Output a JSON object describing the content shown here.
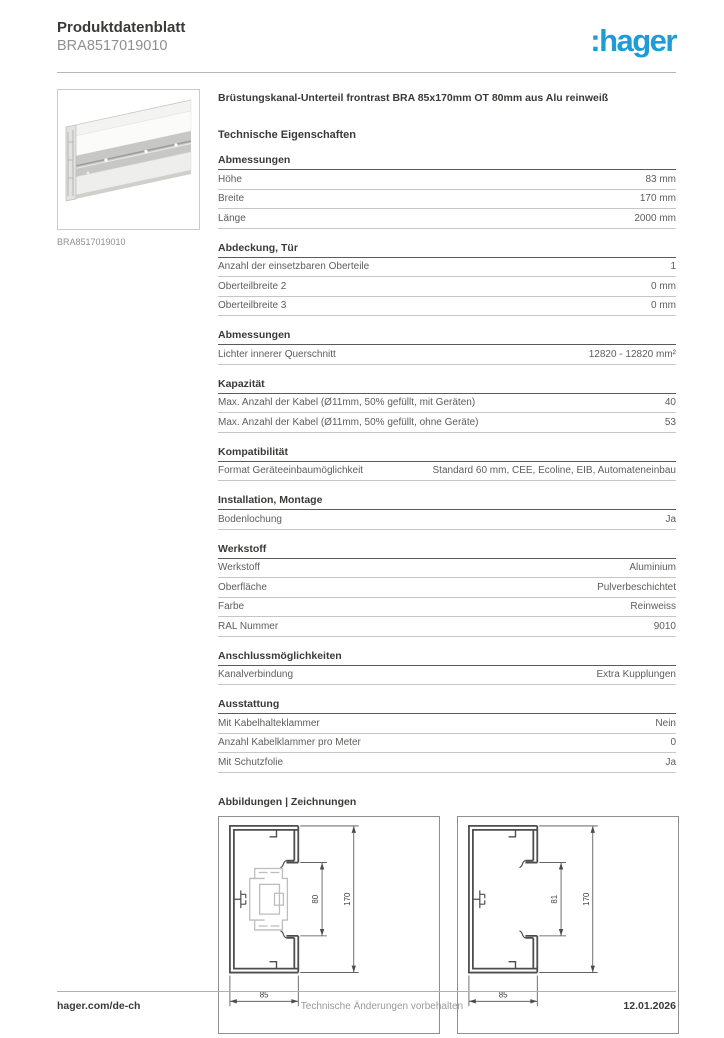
{
  "header": {
    "doc_type": "Produktdatenblatt",
    "product_ref": "BRA8517019010",
    "logo_text": ":hager",
    "logo_color": "#1d9cd8"
  },
  "product": {
    "image_caption": "BRA8517019010",
    "title": "Brüstungskanal-Unterteil frontrast BRA 85x170mm OT 80mm aus Alu reinweiß",
    "tech_section_title": "Technische Eigenschaften"
  },
  "spec_sections": [
    {
      "heading": "Abmessungen",
      "rows": [
        {
          "label": "Höhe",
          "value": "83 mm"
        },
        {
          "label": "Breite",
          "value": "170 mm"
        },
        {
          "label": "Länge",
          "value": "2000 mm"
        }
      ]
    },
    {
      "heading": "Abdeckung, Tür",
      "rows": [
        {
          "label": "Anzahl der einsetzbaren Oberteile",
          "value": "1"
        },
        {
          "label": "Oberteilbreite 2",
          "value": "0 mm"
        },
        {
          "label": "Oberteilbreite 3",
          "value": "0 mm"
        }
      ]
    },
    {
      "heading": "Abmessungen",
      "rows": [
        {
          "label": "Lichter innerer Querschnitt",
          "value": "12820 - 12820 mm²"
        }
      ]
    },
    {
      "heading": "Kapazität",
      "rows": [
        {
          "label": "Max. Anzahl der Kabel (Ø11mm, 50% gefüllt, mit Geräten)",
          "value": "40"
        },
        {
          "label": "Max. Anzahl der Kabel (Ø11mm, 50% gefüllt, ohne Geräte)",
          "value": "53"
        }
      ]
    },
    {
      "heading": "Kompatibilität",
      "rows": [
        {
          "label": "Format Geräteeinbaumöglichkeit",
          "value": "Standard 60 mm, CEE, Ecoline, EIB, Automateneinbau"
        }
      ]
    },
    {
      "heading": "Installation, Montage",
      "rows": [
        {
          "label": "Bodenlochung",
          "value": "Ja"
        }
      ]
    },
    {
      "heading": "Werkstoff",
      "rows": [
        {
          "label": "Werkstoff",
          "value": "Aluminium"
        },
        {
          "label": "Oberfläche",
          "value": "Pulverbeschichtet"
        },
        {
          "label": "Farbe",
          "value": "Reinweiss"
        },
        {
          "label": "RAL Nummer",
          "value": "9010"
        }
      ]
    },
    {
      "heading": "Anschlussmöglichkeiten",
      "rows": [
        {
          "label": "Kanalverbindung",
          "value": "Extra Kupplungen"
        }
      ]
    },
    {
      "heading": "Ausstattung",
      "rows": [
        {
          "label": "Mit Kabelhalteklammer",
          "value": "Nein"
        },
        {
          "label": "Anzahl Kabelklammer pro Meter",
          "value": "0"
        },
        {
          "label": "Mit Schutzfolie",
          "value": "Ja"
        }
      ]
    }
  ],
  "drawings": {
    "heading": "Abbildungen | Zeichnungen",
    "items": [
      {
        "dim_inner": "80",
        "dim_outer": "170",
        "dim_width": "85",
        "with_device": true
      },
      {
        "dim_inner": "81",
        "dim_outer": "170",
        "dim_width": "85",
        "with_device": false
      }
    ]
  },
  "footer": {
    "website": "hager.com/de-ch",
    "notice": "Technische Änderungen vorbehalten",
    "date": "12.01.2026"
  }
}
